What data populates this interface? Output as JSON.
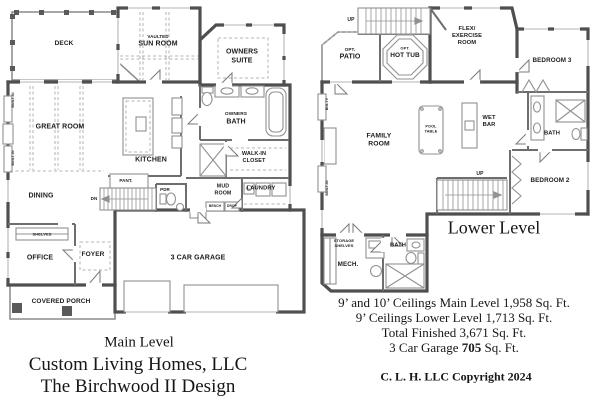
{
  "colors": {
    "exterior_wall": "#4f4f4f",
    "interior_wall": "#6e6e6e",
    "thin_line": "#919191",
    "dashed_line": "#b3b3b3",
    "label_text": "#1c1c1c",
    "title_text": "#161616"
  },
  "main_level": {
    "labels": {
      "deck": "DECK",
      "vaulted": "VAULTED",
      "sun_room": "SUN ROOM",
      "owners_suite": "OWNERS\nSUITE",
      "built_in_a": "BUILT-IN",
      "built_in_b": "BUILT-IN",
      "great_room": "GREAT ROOM",
      "kitchen": "KITCHEN",
      "owners": "OWNERS",
      "bath": "BATH",
      "walk_in_closet": "WALK-IN\nCLOSET",
      "pantry": "PANT.",
      "dn": "DN",
      "pdr": "PDR",
      "mud_room": "MUD\nROOM",
      "laundry": "LAUNDRY",
      "bench": "BENCH",
      "drop": "DROP",
      "dining": "DINING",
      "shelves": "SHELVES",
      "office": "OFFICE",
      "foyer": "FOYER",
      "garage": "3 CAR GARAGE",
      "covered_porch": "COVERED PORCH"
    }
  },
  "lower_level": {
    "labels": {
      "up_top": "UP",
      "opt_a": "OPT.",
      "patio": "PATIO",
      "opt_b": "OPT.",
      "hot_tub": "HOT TUB",
      "flex_room": "FLEX/\nEXERCISE\nROOM",
      "bedroom_3": "BEDROOM 3",
      "big_tv": "BIG-TV",
      "family_room": "FAMILY\nROOM",
      "pool_table": "POOL\nTABLE",
      "wet_bar": "WET\nBAR",
      "bath_a": "BATH",
      "bedroom_2": "BEDROOM 2",
      "up_mid": "UP",
      "built_in": "BUILT-IN",
      "storage_shelves": "STORAGE\nSHELVES",
      "mech": "MECH.",
      "bath_b": "BATH"
    }
  },
  "titles": {
    "main": "Main Level",
    "lower": "Lower Level"
  },
  "footer": {
    "company": "Custom Living Homes, LLC",
    "design": "The Birchwood II Design",
    "stats": [
      "9’ and 10’ Ceilings Main Level 1,958 Sq. Ft.",
      "9’ Ceilings Lower Level 1,713 Sq. Ft.",
      "Total Finished 3,671 Sq. Ft."
    ],
    "garage": {
      "prefix": "3 Car Garage ",
      "bold": "705",
      "suffix": " Sq. Ft."
    },
    "copyright": "C. L. H. LLC Copyright 2024"
  }
}
